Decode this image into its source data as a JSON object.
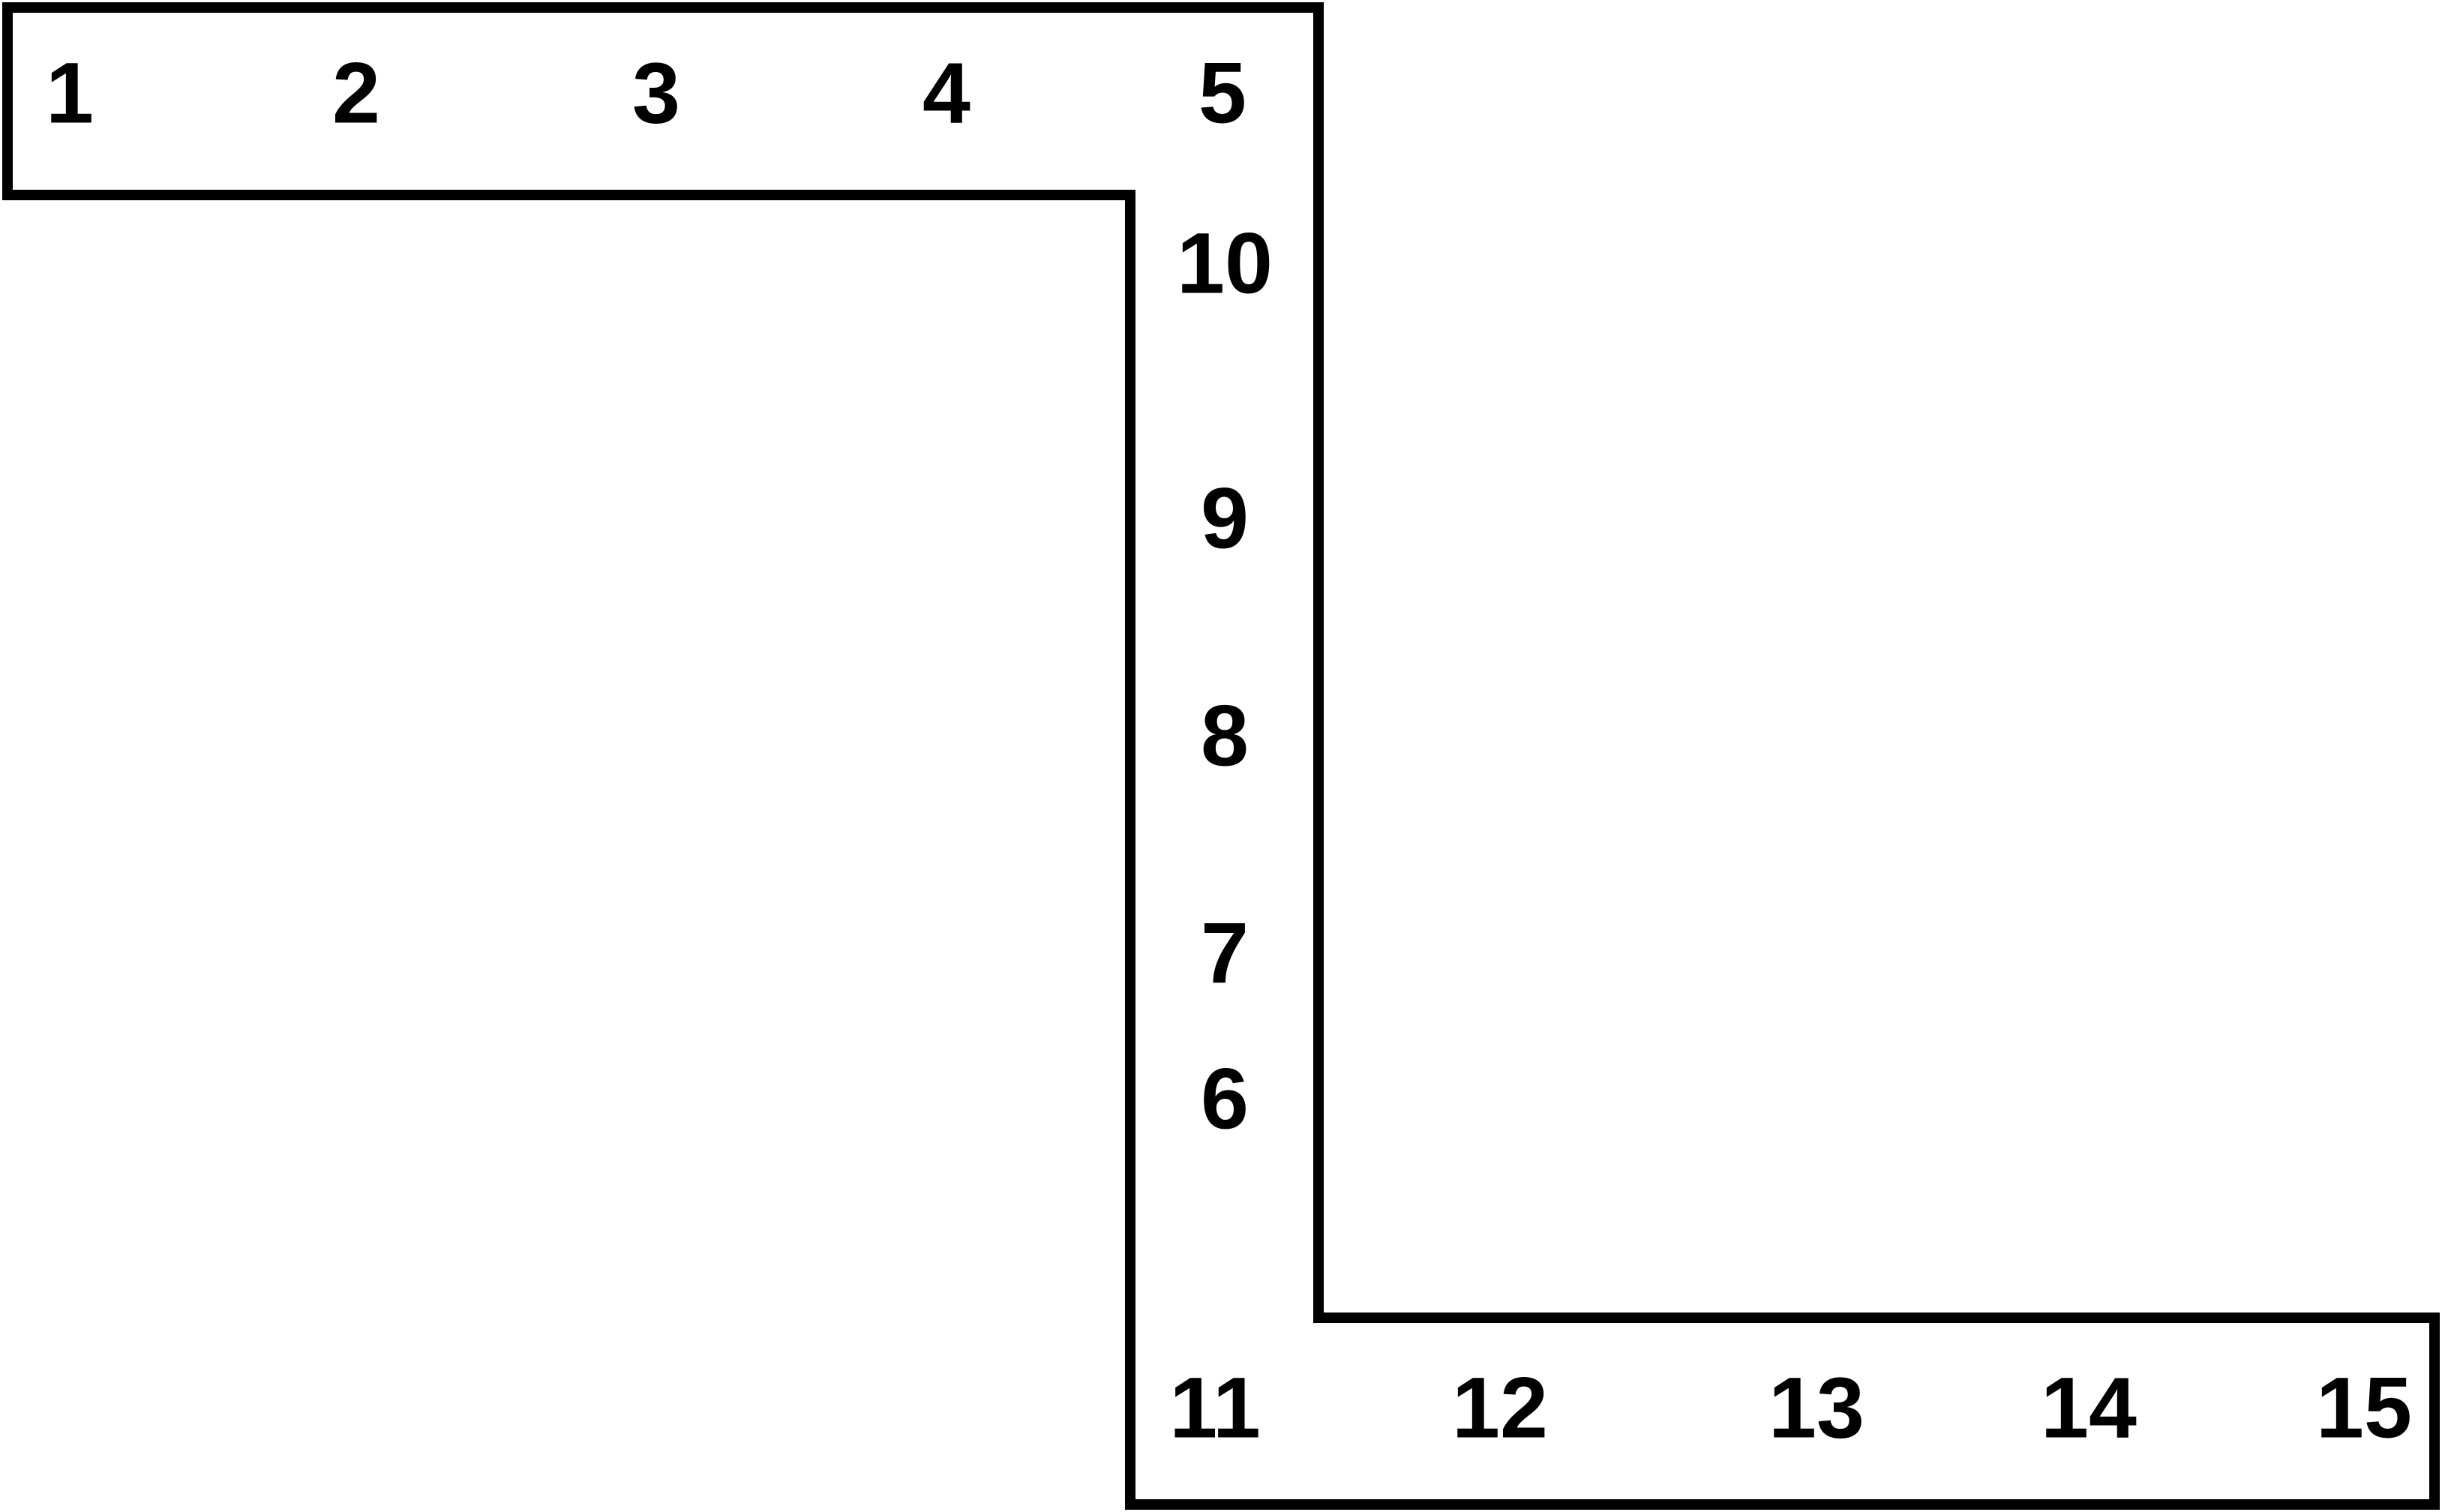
{
  "diagram": {
    "background_color": "#ffffff",
    "outline_color": "#000000",
    "top_row_labels": [
      "1",
      "2",
      "3",
      "4",
      "5"
    ],
    "column_labels": [
      "10",
      "9",
      "8",
      "7",
      "6"
    ],
    "bottom_row_labels": [
      "11",
      "12",
      "13",
      "14",
      "15"
    ]
  }
}
